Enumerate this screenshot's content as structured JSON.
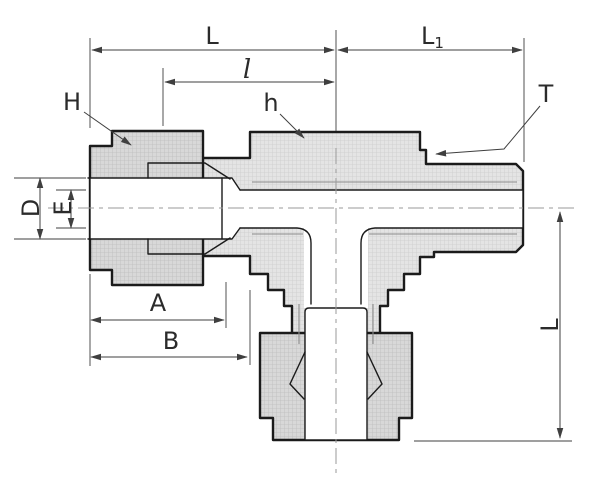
{
  "drawing": {
    "colors": {
      "outline": "#1b1b1b",
      "dimension": "#3f3f3f",
      "body_fill": "#e3e3e3",
      "nut_fill": "#d6d6d6",
      "centerline": "#9a9a9a"
    },
    "labels": {
      "length_left_run": "L",
      "length_right_run_base": "L",
      "length_right_run_sub": "1",
      "length_partial": "l",
      "nut_hex": "H",
      "body_hex": "h",
      "thread": "T",
      "tube_hole_dia": "D",
      "bore_dia": "E",
      "nut_length": "A",
      "assembly_length": "B",
      "drop_length": "L"
    }
  }
}
